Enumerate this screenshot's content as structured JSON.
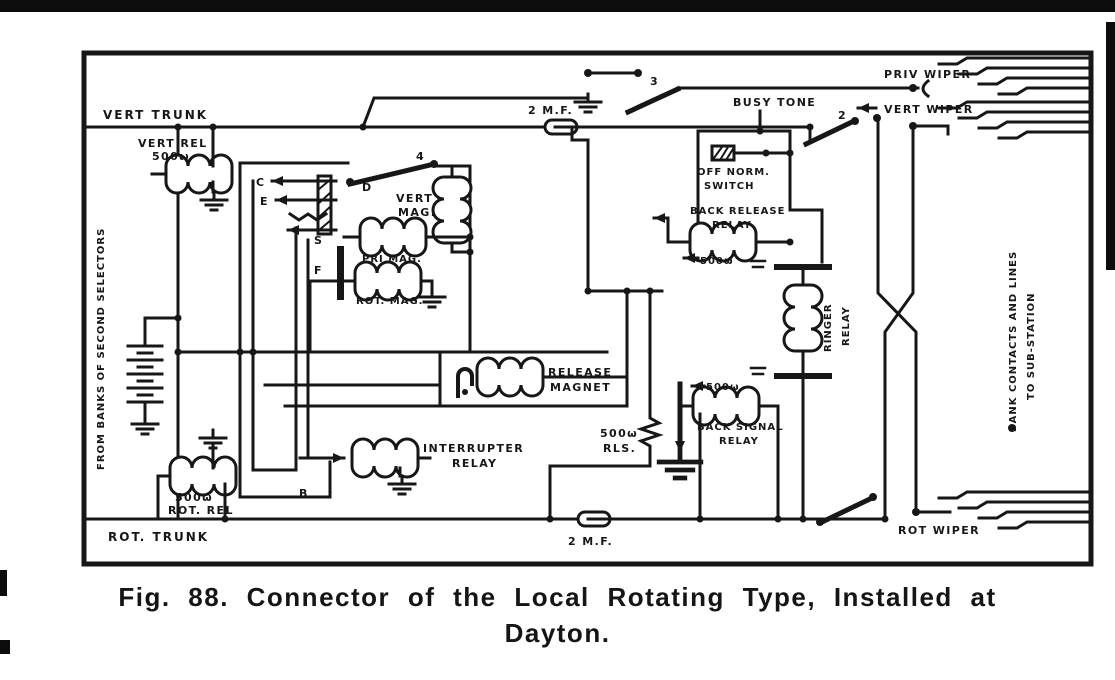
{
  "figure": {
    "caption_line1": "Fig. 88.  Connector of the Local Rotating Type, Installed at",
    "caption_line2": "Dayton.",
    "ink_color": "#171717",
    "paper_color": "#ffffff"
  },
  "diagram": {
    "labels": {
      "vert_trunk": "VERT TRUNK",
      "vert_rel": "VERT REL",
      "vert_rel_ohm": "500ω",
      "from_banks": "FROM BANKS OF SECOND SELECTORS",
      "cap_top": "2 M.F.",
      "cap_bottom": "2 M.F.",
      "n2": "2",
      "n3": "3",
      "n4": "4",
      "busy_tone": "BUSY TONE",
      "priv_wiper": "PRIV WIPER",
      "vert_wiper": "VERT WIPER",
      "rot_wiper": "ROT WIPER",
      "off_norm_1": "OFF NORM.",
      "off_norm_2": "SWITCH",
      "back_release_1": "BACK RELEASE",
      "back_release_2": "RELAY",
      "back_release_ohm": "500ω",
      "vert_mag_1": "VERT",
      "vert_mag_2": "MAG.",
      "pri_mag": "PRI MAG.",
      "rot_mag": "ROT. MAG.",
      "release_magnet_1": "RELEASE",
      "release_magnet_2": "MAGNET",
      "ringer_relay_1": "RINGER",
      "ringer_relay_2": "RELAY",
      "bank_contacts_1": "BANK CONTACTS AND LINES",
      "bank_contacts_2": "TO SUB-STATION",
      "interrupter_1": "INTERRUPTER",
      "interrupter_2": "RELAY",
      "rls_ohm_1": "500ω",
      "rls_ohm_2": "RLS.",
      "back_signal_ohm": "500ω",
      "back_signal_1": "BACK SIGNAL",
      "back_signal_2": "RELAY",
      "rot_rel_1": "500ω",
      "rot_rel_2": "ROT. REL",
      "rot_trunk": "ROT. TRUNK",
      "contact_c": "C",
      "contact_d": "D",
      "contact_e": "E",
      "contact_s": "S",
      "contact_f": "F",
      "contact_b": "B"
    }
  }
}
